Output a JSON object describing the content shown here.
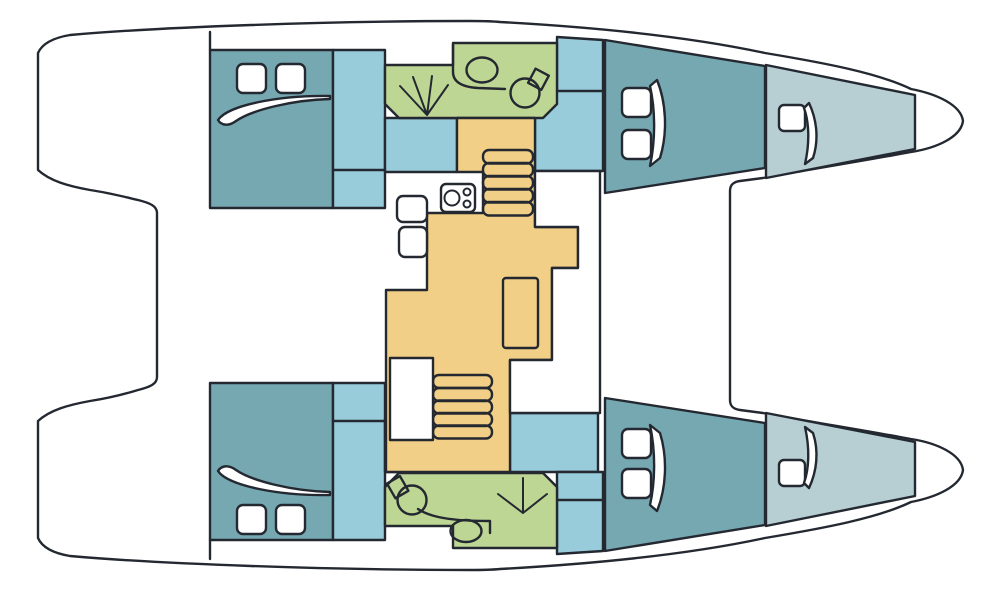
{
  "diagram": {
    "type": "boat-floor-plan",
    "subject": "catamaran-deck-plan-top-view-bow-right",
    "colors": {
      "background": "#ffffff",
      "line": "#242931",
      "deck": "#ffffff",
      "cabin": "#76a8b2",
      "walkway": "#99ccda",
      "foredeck": "#b7cfd3",
      "bathroom": "#bed694",
      "salon": "#f2cf86"
    },
    "areas": [
      {
        "name": "port-aft-cabin",
        "fill": "cabin"
      },
      {
        "name": "port-forward-cabin",
        "fill": "cabin"
      },
      {
        "name": "starboard-aft-cabin",
        "fill": "cabin"
      },
      {
        "name": "starboard-forward-cabin",
        "fill": "cabin"
      },
      {
        "name": "port-head",
        "fill": "bathroom"
      },
      {
        "name": "starboard-head",
        "fill": "bathroom"
      },
      {
        "name": "port-forepeak",
        "fill": "foredeck"
      },
      {
        "name": "starboard-forepeak",
        "fill": "foredeck"
      },
      {
        "name": "salon-and-galley",
        "fill": "salon"
      },
      {
        "name": "companionways-and-passages",
        "fill": "walkway"
      },
      {
        "name": "deck-and-cockpit",
        "fill": "deck"
      }
    ],
    "fixtures": [
      "double-berth",
      "deck-hatch",
      "companionway-stairs",
      "salon-table",
      "galley-stove",
      "galley-sink",
      "bathroom-sink",
      "toilet",
      "shower"
    ]
  }
}
